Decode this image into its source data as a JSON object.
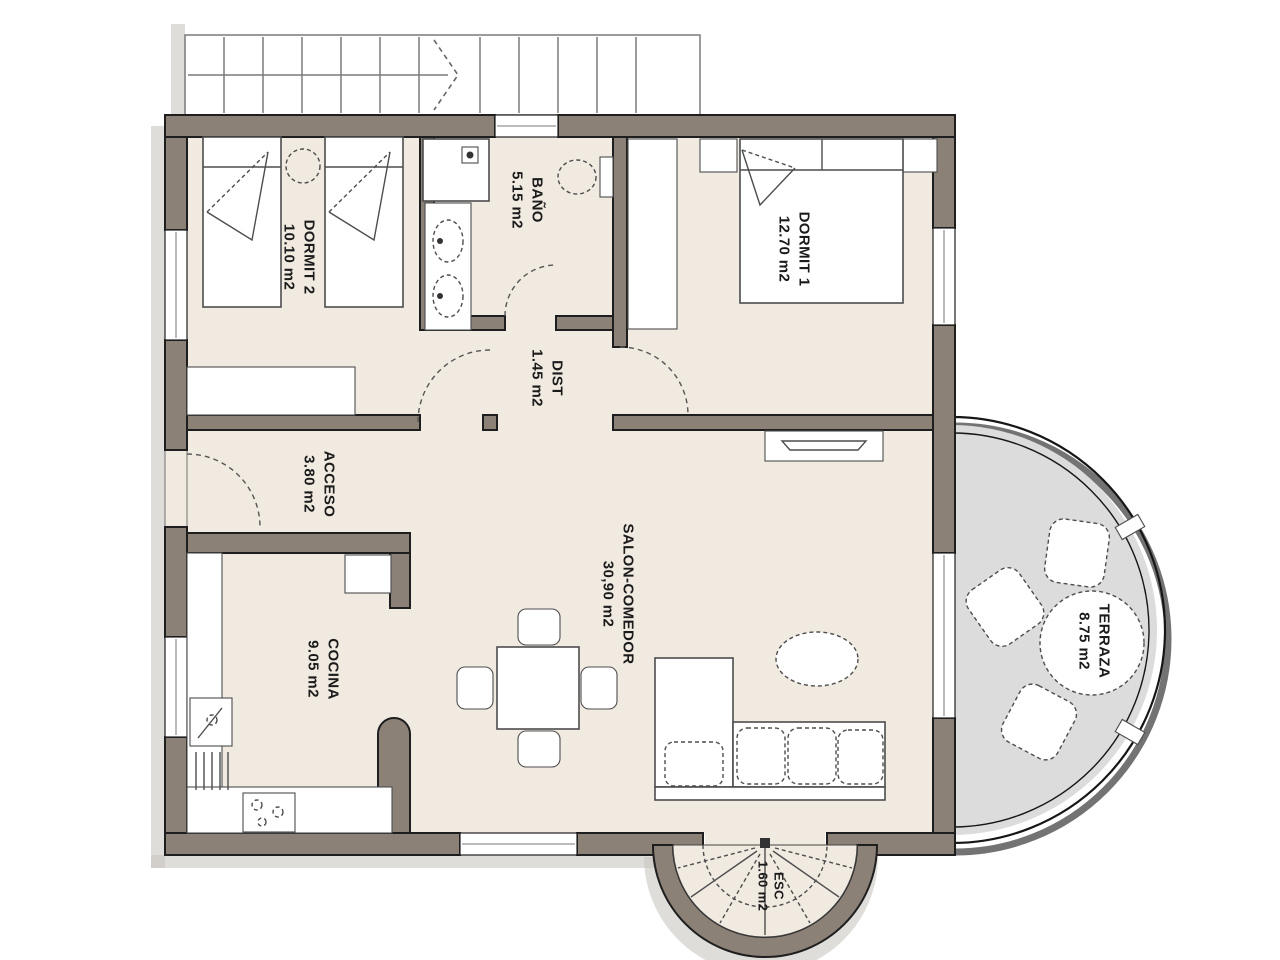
{
  "canvas": {
    "width": 1280,
    "height": 960
  },
  "colors": {
    "background": "#ffffff",
    "wall": "#8b8177",
    "line": "#1e1e1e",
    "floor": "#f1eae1",
    "terrace": "#dbdcdb",
    "furniture_line": "#4d4d4d",
    "stair_line": "#7a7a7a",
    "shadow": "#c9c6c2",
    "text": "#1b1b1b"
  },
  "rooms": {
    "dormit2": {
      "name": "DORMIT 2",
      "area": "10.10 m2"
    },
    "bano": {
      "name": "BAÑO",
      "area": "5.15 m2"
    },
    "dormit1": {
      "name": "DORMIT 1",
      "area": "12.70 m2"
    },
    "dist": {
      "name": "DIST",
      "area": "1.45 m2"
    },
    "acceso": {
      "name": "ACCESO",
      "area": "3.80 m2"
    },
    "cocina": {
      "name": "COCINA",
      "area": "9.05 m2"
    },
    "salon": {
      "name": "SALON-COMEDOR",
      "area": "30,90 m2"
    },
    "terraza": {
      "name": "TERRAZA",
      "area": "8.75 m2"
    },
    "esc": {
      "name": "ESC",
      "area": "1.60 m2"
    }
  }
}
